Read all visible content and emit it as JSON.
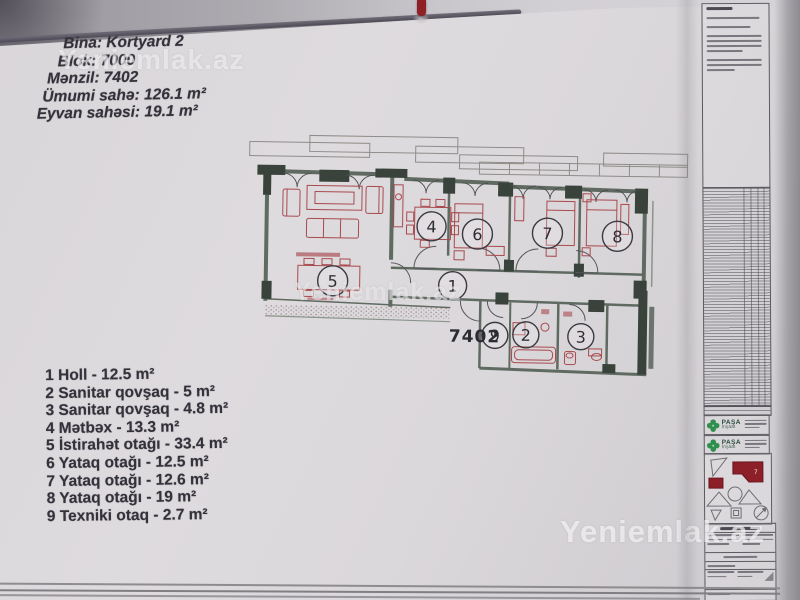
{
  "watermarks": {
    "top": "Yeniemlak.az",
    "center": "Yeniemlak.az",
    "bottom": "Yeniemlak.az"
  },
  "header": {
    "lines": [
      "Bina: Kortyard 2",
      "Blok: 7000",
      "Mənzil: 7402",
      "Ümumi sahə: 126.1 m²",
      "Eyvan sahəsi: 19.1 m²"
    ]
  },
  "plan": {
    "apartment_number": "7402",
    "rooms": [
      "1",
      "2",
      "3",
      "4",
      "5",
      "6",
      "7",
      "8",
      "9"
    ]
  },
  "room_list": [
    "1 Holl - 12.5 m²",
    "2 Sanitar qovşaq - 5 m²",
    "3 Sanitar qovşaq - 4.8 m²",
    "4 Mətbəx - 13.3 m²",
    "5 İstirahət otağı - 33.4 m²",
    "6 Yataq otağı - 12.5 m²",
    "7 Yataq otağı - 12.6 m²",
    "8 Yataq otağı - 19 m²",
    "9 Texniki otaq - 2.7 m²"
  ],
  "title_block": {
    "logo_text": "PAŞA",
    "logo_sub": "İnşaat"
  },
  "colors": {
    "wall_dark": "#39433b",
    "wall_mid": "#5f6a61",
    "furniture_red": "#a84a4e",
    "keyplan_red": "#8c1f28",
    "logo_green": "#2f8f4e"
  }
}
